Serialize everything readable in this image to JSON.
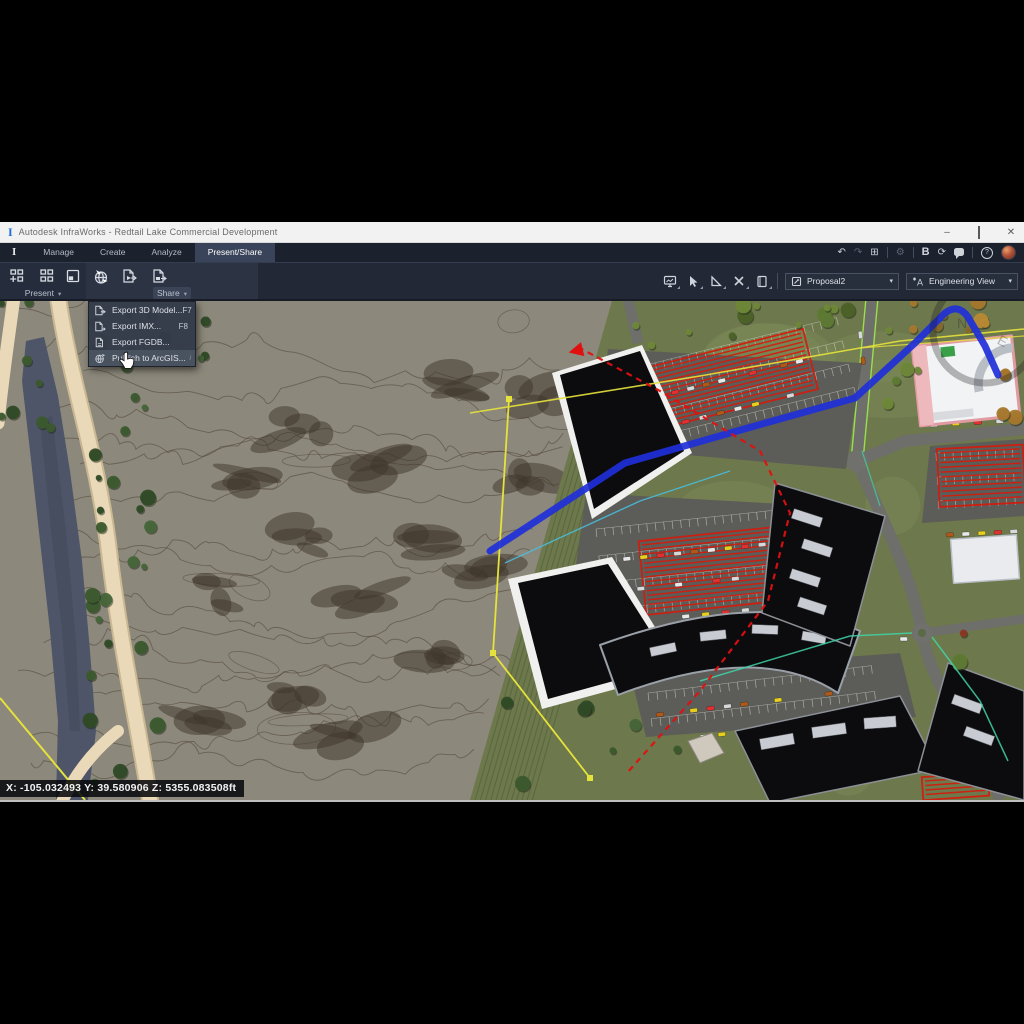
{
  "window": {
    "title": "Autodesk InfraWorks - Redtail Lake Commercial Development"
  },
  "branding": {
    "app_glyph": "I"
  },
  "icons": {
    "minimize": "–",
    "close": "✕",
    "dropdown_arrow": "▾",
    "undo": "↶",
    "redo": "↷",
    "windows": "⊞",
    "settings": "⚙",
    "bold_b": "B",
    "sync": "⟳",
    "help": "?"
  },
  "ribbon": {
    "tabs": [
      {
        "label": "Manage"
      },
      {
        "label": "Create"
      },
      {
        "label": "Analyze"
      },
      {
        "label": "Present/Share",
        "active": true
      }
    ]
  },
  "toolbar": {
    "present_group": {
      "label": "Present"
    },
    "share_group": {
      "label": "Share"
    }
  },
  "view_controls": {
    "proposal": {
      "value": "Proposal2"
    },
    "view_style": {
      "value": "Engineering View"
    }
  },
  "share_menu": {
    "items": [
      {
        "label": "Export 3D Model...",
        "shortcut": "F7"
      },
      {
        "label": "Export IMX...",
        "shortcut": "F8"
      },
      {
        "label": "Export FGDB...",
        "shortcut": ""
      },
      {
        "label": "Publish to ArcGIS...",
        "shortcut": "",
        "trailing": "i",
        "highlighted": true
      }
    ]
  },
  "status_bar": {
    "coordinates": "X: -105.032493 Y: 39.580906 Z: 5355.083508ft"
  },
  "viewport": {
    "compass": {
      "north": "N",
      "east": "E"
    }
  },
  "colors": {
    "ribbon_bg": "#222836",
    "active_tab": "#39435a",
    "route_blue": "#2030d8",
    "analysis_red": "#d41b0d",
    "boundary_yellow": "#e6e23c",
    "road_lime": "#9adf4e",
    "terrain": "#8c887b",
    "grass": "#6d784c"
  }
}
